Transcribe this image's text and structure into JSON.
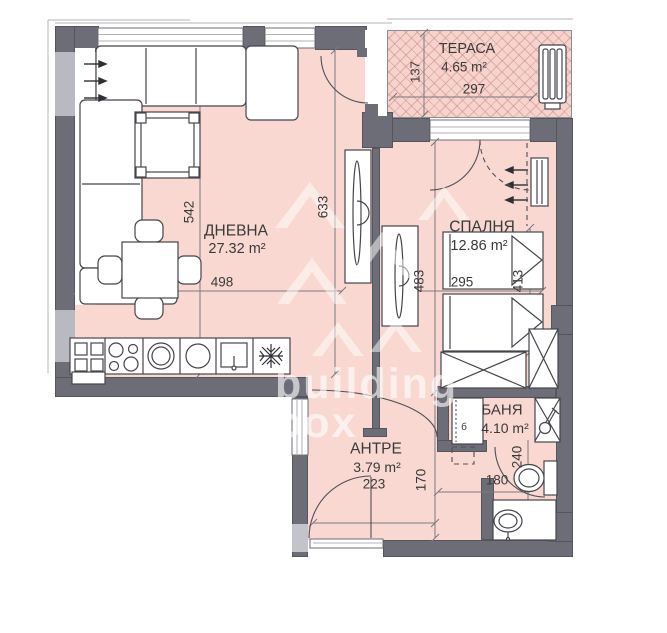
{
  "watermark": {
    "line1": "building",
    "line2": "box"
  },
  "rooms": {
    "living": {
      "name": "ДНЕВНА",
      "area": "27.32 m²"
    },
    "terrace": {
      "name": "ТЕРАСА",
      "area": "4.65 m²"
    },
    "bedroom": {
      "name": "СПАЛНЯ",
      "area": "12.86 m²"
    },
    "hall": {
      "name": "АНТРЕ",
      "area": "3.79 m²"
    },
    "bath": {
      "name": "БАНЯ",
      "area": "4.10 m²",
      "tag": "б"
    }
  },
  "dims": {
    "living_width": "498",
    "living_height": "542",
    "living_full_height": "633",
    "terrace_width": "297",
    "terrace_depth": "137",
    "bedroom_width": "295",
    "bedroom_length": "413",
    "right_wing_height": "483",
    "hall_width": "223",
    "hall_depth": "170",
    "bath_width": "180",
    "bath_depth": "240"
  },
  "colors": {
    "floor_pink": "#f8d8d1",
    "wall_gray": "#6d6d77",
    "line_dark": "#45454c"
  }
}
